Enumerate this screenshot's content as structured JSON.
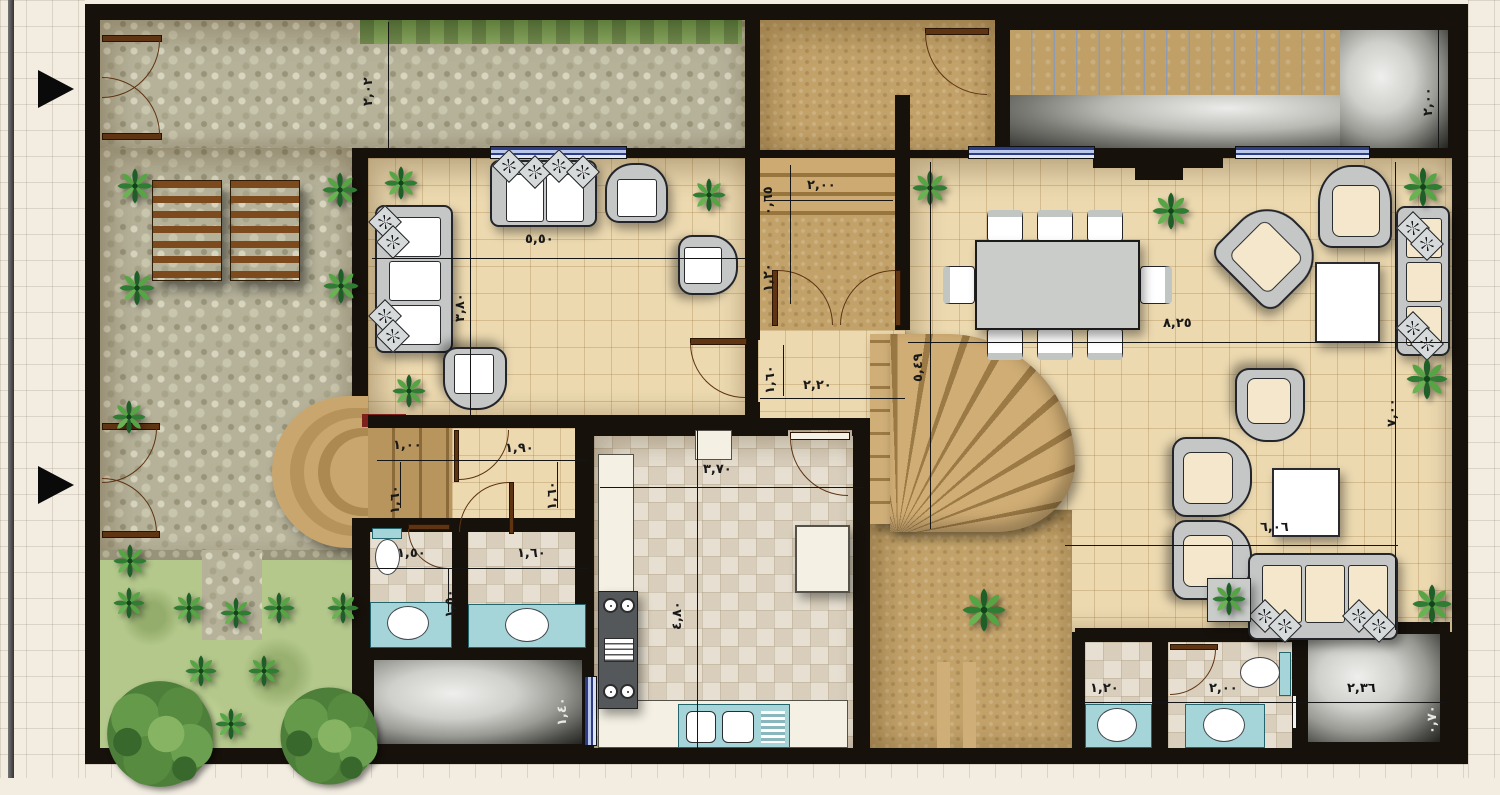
{
  "plan": {
    "kind": "villa-ground-floor-plan",
    "units": "meters",
    "numerals": "arabic-indic"
  },
  "dimension_labels": {
    "garden_side": {
      "passage_depth": "٢,٠٢"
    },
    "terrace_top_right": {
      "depth": "٢,٠٠"
    },
    "guest_living_room": {
      "width": "٥,٥٠",
      "depth": "٣,٨٠"
    },
    "entrance_steps": {
      "width": "٢,٠٠",
      "upper_depth": "٠,٦٥",
      "lower_depth": "١,٢٠"
    },
    "entry_hall": {
      "depth": "١,٦٠",
      "width": "٢,٢٠"
    },
    "dining_hall": {
      "width": "٨,٢٥",
      "depth": "٥,٤٩"
    },
    "family_hall": {
      "depth": "٧,٠٠",
      "width": "٦,٠٦"
    },
    "kitchen": {
      "width": "٣,٧٠",
      "depth": "٤,٨٠"
    },
    "inner_corridor": {
      "landing_width": "١,٠٠",
      "width": "١,٩٠",
      "left_depth": "١,٦٠",
      "right_depth": "١,٦٠"
    },
    "bathroom_left_1": {
      "width": "١,٥٠",
      "door_depth": "١,٥٠"
    },
    "bathroom_left_2": {
      "width": "١,٦٠"
    },
    "light_well_left": {
      "depth": "١,٤٠"
    },
    "bathroom_right_1": {
      "width": "١,٢٠"
    },
    "bathroom_right_2": {
      "width": "٢,٠٠"
    },
    "light_well_right": {
      "width": "٢,٣٦",
      "depth": "٠,٧٠"
    }
  },
  "colors": {
    "wall": "#17110b",
    "tile_floor": "#ecd9b0",
    "stone_paving": "#b6b29a",
    "entrance_brown": "#c2a269",
    "deck_wood": "#c0a067",
    "grass": "#b4c88c",
    "kitchen_mosaic": "#e7e0d2",
    "counter_teal": "#a5d5d9",
    "window_glass": "#2e3c86",
    "accent_red": "#7e211c",
    "shaft_stone": "#9a9a95",
    "furniture_frame": "#c4c7c6",
    "cushion_cream": "#f4e7cb",
    "plant_green": "#2f7d33"
  },
  "icons": {
    "plant": "palm-plant-icon",
    "tree": "tree-icon",
    "pillow": "pillow-star-icon",
    "entry_arrow": "entry-arrow-icon",
    "door_swing": "door-swing-icon",
    "toilet": "toilet-icon",
    "sink": "sink-icon",
    "stove": "stove-icon",
    "staircase": "staircase-icon",
    "pergola": "pergola-icon",
    "dining_table": "dining-table-icon",
    "sofa": "sofa-icon"
  }
}
